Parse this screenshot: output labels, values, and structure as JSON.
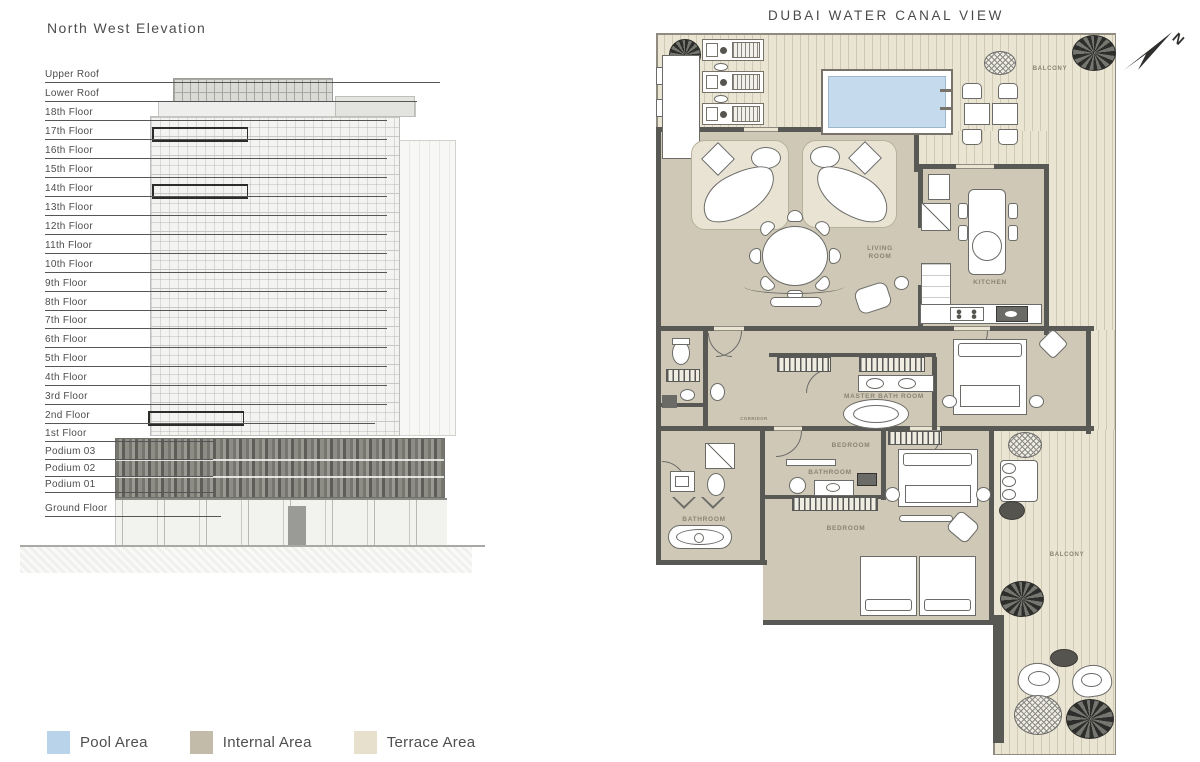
{
  "elevation": {
    "title": "North West Elevation",
    "floors": [
      "Upper Roof",
      "Lower Roof",
      "18th Floor",
      "17th Floor",
      "16th Floor",
      "15th Floor",
      "14th Floor",
      "13th Floor",
      "12th Floor",
      "11th Floor",
      "10th Floor",
      "9th Floor",
      "8th Floor",
      "7th Floor",
      "6th Floor",
      "5th Floor",
      "4th Floor",
      "3rd Floor",
      "2nd Floor",
      "1st Floor",
      "Podium 03",
      "Podium 02",
      "Podium 01",
      "Ground Floor"
    ],
    "highlighted_floors": [
      "17th Floor",
      "14th Floor",
      "2nd Floor"
    ]
  },
  "plan": {
    "title": "DUBAI WATER CANAL VIEW",
    "compass": "N",
    "rooms": {
      "living": "LIVING ROOM",
      "kitchen": "KITCHEN",
      "master_bath": "MASTER BATH ROOM",
      "master_bedroom": "BEDROOM",
      "bathroom_mid": "BATHROOM",
      "bedroom_2": "BEDROOM",
      "bathroom_2": "BATHROOM",
      "corridor": "CORRIDOR",
      "balcony_top": "BALCONY",
      "balcony_right": "BALCONY"
    }
  },
  "legend": {
    "items": [
      {
        "label": "Pool Area",
        "color": "#b9d4ea"
      },
      {
        "label": "Internal Area",
        "color": "#c2bbaa"
      },
      {
        "label": "Terrace Area",
        "color": "#e7e0cd"
      }
    ]
  },
  "colors": {
    "internal_area": "#cfc8b6",
    "terrace_area": "#eae4d3",
    "pool_water": "#c5daed",
    "wall": "#585855",
    "room_label": "#8b8373",
    "unit_highlight": "#c9c1ac"
  }
}
